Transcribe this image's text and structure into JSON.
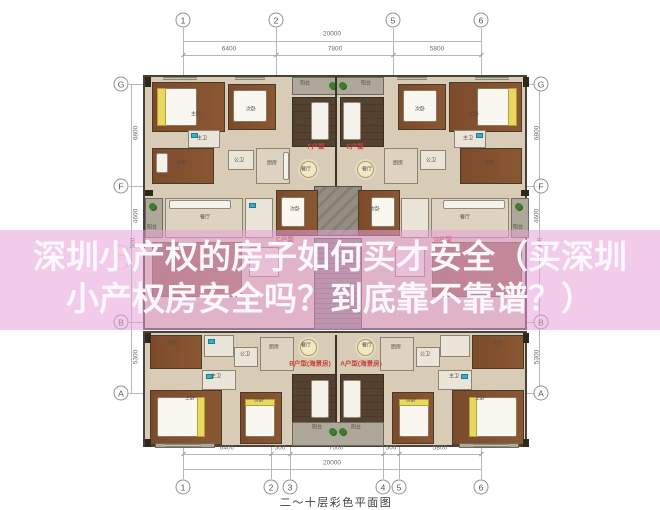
{
  "overlay": {
    "line1": "深圳小产权的房子如何买才安全（买深圳",
    "line2": "小产权房安全吗？到底靠不靠谱？）",
    "band_color": "#e79ed8",
    "text_color": "#fbf7fa"
  },
  "caption": "二～十层彩色平面图",
  "grid_markers": [
    {
      "label": "1",
      "x": 183,
      "y": 20
    },
    {
      "label": "2",
      "x": 276,
      "y": 20
    },
    {
      "label": "5",
      "x": 393,
      "y": 20
    },
    {
      "label": "6",
      "x": 481,
      "y": 20
    },
    {
      "label": "1",
      "x": 183,
      "y": 487
    },
    {
      "label": "2",
      "x": 271,
      "y": 487
    },
    {
      "label": "3",
      "x": 290,
      "y": 487
    },
    {
      "label": "4",
      "x": 383,
      "y": 487
    },
    {
      "label": "5",
      "x": 399,
      "y": 487
    },
    {
      "label": "6",
      "x": 481,
      "y": 487
    },
    {
      "label": "G",
      "x": 121,
      "y": 84
    },
    {
      "label": "F",
      "x": 121,
      "y": 186
    },
    {
      "label": "",
      "x": 121,
      "y": 252,
      "faint": true
    },
    {
      "label": "",
      "x": 121,
      "y": 262,
      "faint": true
    },
    {
      "label": "B",
      "x": 121,
      "y": 322
    },
    {
      "label": "A",
      "x": 121,
      "y": 393
    },
    {
      "label": "G",
      "x": 541,
      "y": 84
    },
    {
      "label": "F",
      "x": 541,
      "y": 186
    },
    {
      "label": "B",
      "x": 541,
      "y": 322
    },
    {
      "label": "A",
      "x": 541,
      "y": 393
    }
  ],
  "dim_labels": [
    {
      "text": "20000",
      "x": 332,
      "y": 34
    },
    {
      "text": "6400",
      "x": 229,
      "y": 49
    },
    {
      "text": "7800",
      "x": 335,
      "y": 49
    },
    {
      "text": "5800",
      "x": 437,
      "y": 49
    },
    {
      "text": "6400",
      "x": 227,
      "y": 448
    },
    {
      "text": "500",
      "x": 280,
      "y": 448
    },
    {
      "text": "7000",
      "x": 336,
      "y": 448
    },
    {
      "text": "500",
      "x": 391,
      "y": 448
    },
    {
      "text": "5800",
      "x": 440,
      "y": 448
    },
    {
      "text": "20000",
      "x": 332,
      "y": 463
    },
    {
      "text": "6800",
      "x": 136,
      "y": 133,
      "rot": true
    },
    {
      "text": "4600",
      "x": 136,
      "y": 216,
      "rot": true
    },
    {
      "text": "500",
      "x": 133,
      "y": 243,
      "rot": true
    },
    {
      "text": "5300",
      "x": 136,
      "y": 357,
      "rot": true
    },
    {
      "text": "6800",
      "x": 537,
      "y": 133,
      "rot": true
    },
    {
      "text": "4600",
      "x": 537,
      "y": 216,
      "rot": true
    },
    {
      "text": "500",
      "x": 540,
      "y": 243,
      "rot": true
    },
    {
      "text": "5300",
      "x": 537,
      "y": 357,
      "rot": true
    }
  ],
  "unit_labels": [
    {
      "text": "F户型",
      "x": 316,
      "y": 147
    },
    {
      "text": "E户型",
      "x": 355,
      "y": 147
    },
    {
      "text": "C户型",
      "x": 285,
      "y": 240
    },
    {
      "text": "D户型",
      "x": 443,
      "y": 240
    },
    {
      "text": "B户型(海景房)",
      "x": 310,
      "y": 364
    },
    {
      "text": "A户型(海景房)",
      "x": 361,
      "y": 364
    }
  ],
  "room_labels": [
    {
      "text": "主卧",
      "x": 196,
      "y": 115
    },
    {
      "text": "次卧",
      "x": 251,
      "y": 110
    },
    {
      "text": "主卫",
      "x": 202,
      "y": 139
    },
    {
      "text": "书房",
      "x": 181,
      "y": 164
    },
    {
      "text": "公卫",
      "x": 239,
      "y": 161
    },
    {
      "text": "厨房",
      "x": 272,
      "y": 164
    },
    {
      "text": "阳台",
      "x": 305,
      "y": 84
    },
    {
      "text": "阳台",
      "x": 366,
      "y": 84
    },
    {
      "text": "客厅",
      "x": 300,
      "y": 122
    },
    {
      "text": "客厅",
      "x": 372,
      "y": 122
    },
    {
      "text": "餐厅",
      "x": 306,
      "y": 170
    },
    {
      "text": "餐厅",
      "x": 367,
      "y": 170
    },
    {
      "text": "次卧",
      "x": 420,
      "y": 110
    },
    {
      "text": "主卧",
      "x": 474,
      "y": 115
    },
    {
      "text": "主卫",
      "x": 468,
      "y": 139
    },
    {
      "text": "书房",
      "x": 489,
      "y": 164
    },
    {
      "text": "公卫",
      "x": 431,
      "y": 161
    },
    {
      "text": "厨房",
      "x": 398,
      "y": 164
    },
    {
      "text": "餐厅",
      "x": 205,
      "y": 218
    },
    {
      "text": "餐厅",
      "x": 465,
      "y": 218
    },
    {
      "text": "次卧",
      "x": 295,
      "y": 210
    },
    {
      "text": "次卧",
      "x": 375,
      "y": 210
    },
    {
      "text": "阳台",
      "x": 152,
      "y": 228
    },
    {
      "text": "阳台",
      "x": 518,
      "y": 228
    },
    {
      "text": "书房",
      "x": 172,
      "y": 344
    },
    {
      "text": "厨房",
      "x": 274,
      "y": 348
    },
    {
      "text": "公卫",
      "x": 245,
      "y": 355
    },
    {
      "text": "主卫",
      "x": 216,
      "y": 377
    },
    {
      "text": "主卧",
      "x": 190,
      "y": 399
    },
    {
      "text": "次卧",
      "x": 259,
      "y": 401
    },
    {
      "text": "餐厅",
      "x": 306,
      "y": 346
    },
    {
      "text": "餐厅",
      "x": 367,
      "y": 346
    },
    {
      "text": "客厅",
      "x": 298,
      "y": 393
    },
    {
      "text": "客厅",
      "x": 372,
      "y": 393
    },
    {
      "text": "阳台",
      "x": 317,
      "y": 428
    },
    {
      "text": "阳台",
      "x": 356,
      "y": 428
    },
    {
      "text": "书房",
      "x": 498,
      "y": 344
    },
    {
      "text": "厨房",
      "x": 396,
      "y": 348
    },
    {
      "text": "公卫",
      "x": 425,
      "y": 355
    },
    {
      "text": "主卫",
      "x": 454,
      "y": 377
    },
    {
      "text": "主卧",
      "x": 480,
      "y": 399
    },
    {
      "text": "次卧",
      "x": 411,
      "y": 401
    }
  ],
  "colors": {
    "wood": "#7c4b2a",
    "dark_wood": "#55412f",
    "floor": "#d8ccb7",
    "balcony": "#aea89b",
    "core": "#8e887d",
    "accent_yellow": "#e8d95e",
    "fixture_teal": "#38b1c7",
    "plant_green": "#3e7d2b",
    "wall": "#3b3329",
    "unit_label_red": "#c7423a",
    "dim_gray": "#6a6a6a"
  }
}
